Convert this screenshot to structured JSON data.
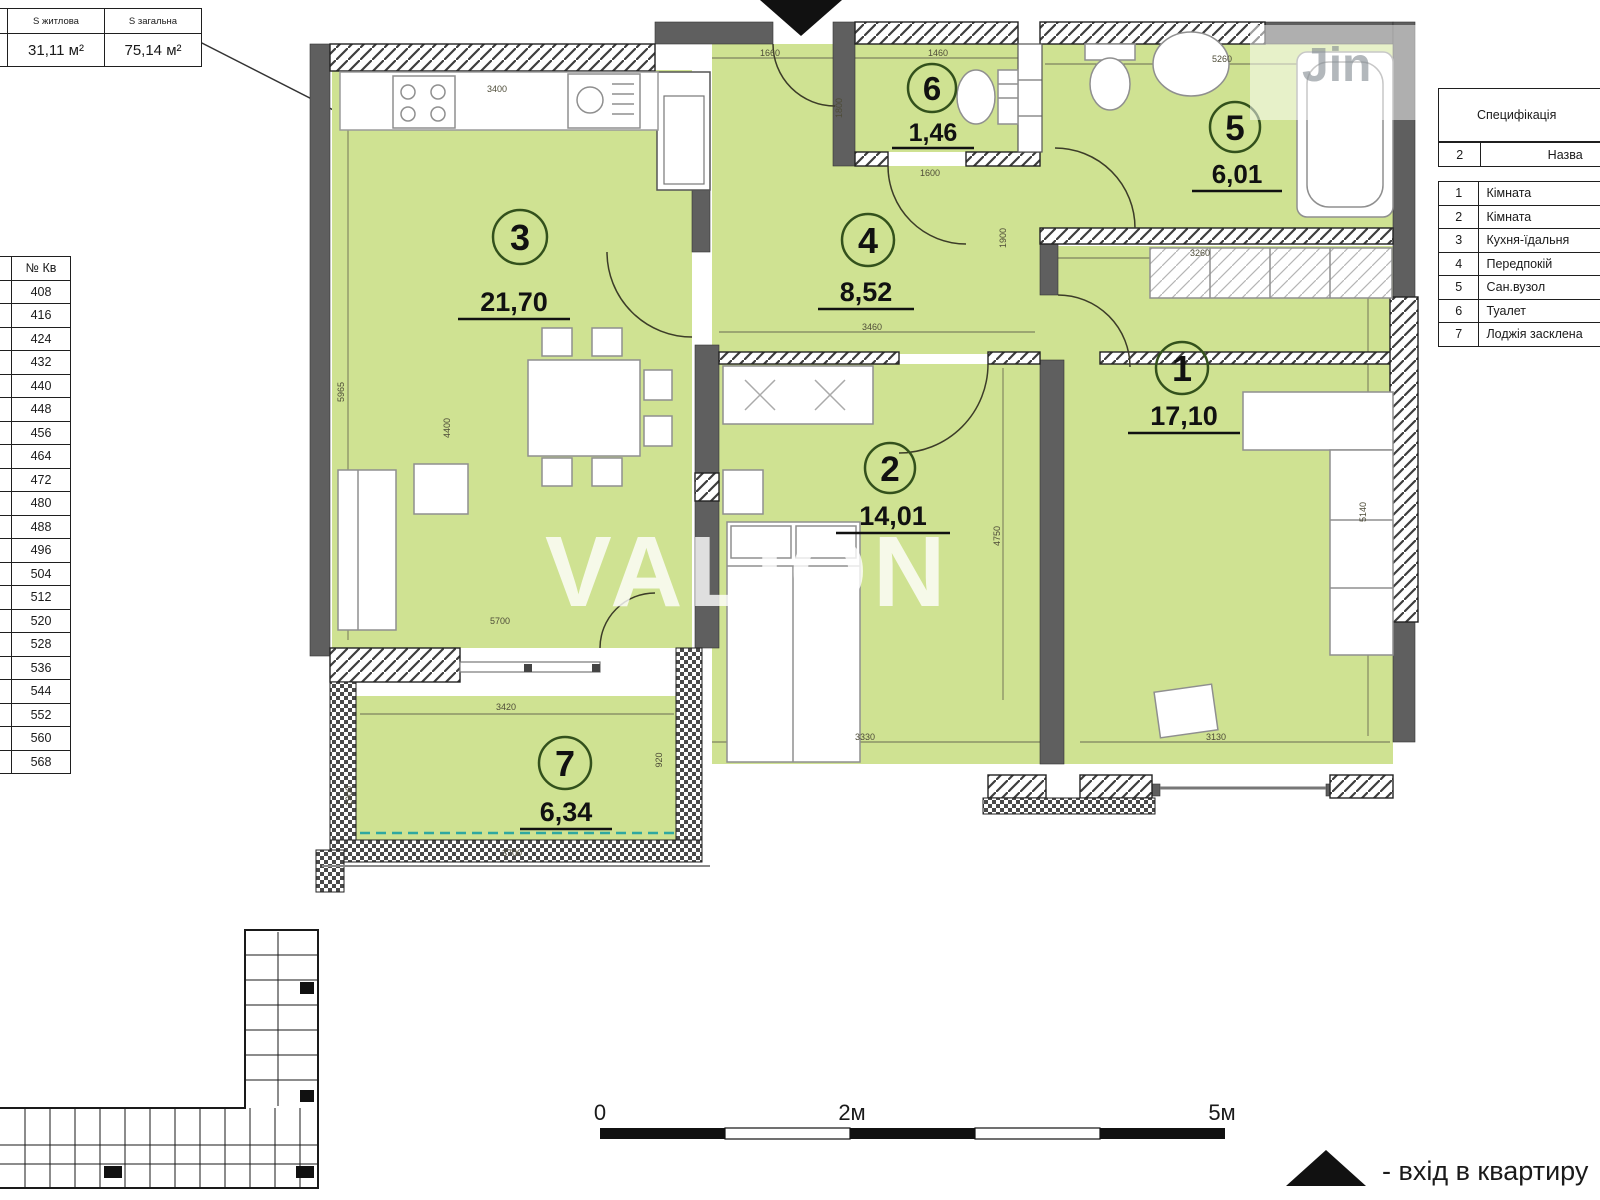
{
  "summary_table": {
    "col_rooms_header": "кімнат",
    "col_rooms_value": "2",
    "col_living_header": "S житлова",
    "col_living_value": "31,11 м²",
    "col_total_header": "S загальна",
    "col_total_value": "75,14 м²"
  },
  "apartments_table": {
    "number_header": "№ Кв",
    "rows": [
      {
        "floor": "2",
        "apt": "408"
      },
      {
        "floor": "3",
        "apt": "416"
      },
      {
        "floor": "4",
        "apt": "424"
      },
      {
        "floor": "5",
        "apt": "432"
      },
      {
        "floor": "6",
        "apt": "440"
      },
      {
        "floor": "7",
        "apt": "448"
      },
      {
        "floor": "8",
        "apt": "456"
      },
      {
        "floor": "9",
        "apt": "464"
      },
      {
        "floor": "10",
        "apt": "472"
      },
      {
        "floor": "11",
        "apt": "480"
      },
      {
        "floor": "12",
        "apt": "488"
      },
      {
        "floor": "13",
        "apt": "496"
      },
      {
        "floor": "14",
        "apt": "504"
      },
      {
        "floor": "15",
        "apt": "512"
      },
      {
        "floor": "16",
        "apt": "520"
      },
      {
        "floor": "17",
        "apt": "528"
      },
      {
        "floor": "18",
        "apt": "536"
      },
      {
        "floor": "19",
        "apt": "544"
      },
      {
        "floor": "20",
        "apt": "552"
      },
      {
        "floor": "21",
        "apt": "560"
      },
      {
        "floor": "22",
        "apt": "568"
      }
    ]
  },
  "spec_table": {
    "title": "Специфікація",
    "header_num": "2",
    "header_name": "Назва",
    "rows": [
      {
        "num": "1",
        "name": "Кімната"
      },
      {
        "num": "2",
        "name": "Кімната"
      },
      {
        "num": "3",
        "name": "Кухня-їдальня"
      },
      {
        "num": "4",
        "name": "Передпокій"
      },
      {
        "num": "5",
        "name": "Сан.вузол"
      },
      {
        "num": "6",
        "name": "Туалет"
      },
      {
        "num": "7",
        "name": "Лоджія засклена"
      }
    ]
  },
  "rooms": {
    "r1": {
      "number": "1",
      "area": "17,10"
    },
    "r2": {
      "number": "2",
      "area": "14,01"
    },
    "r3": {
      "number": "3",
      "area": "21,70"
    },
    "r4": {
      "number": "4",
      "area": "8,52"
    },
    "r5": {
      "number": "5",
      "area": "6,01"
    },
    "r6": {
      "number": "6",
      "area": "1,46"
    },
    "r7": {
      "number": "7",
      "area": "6,34"
    }
  },
  "dims": [
    "3400",
    "1660",
    "1460",
    "5260",
    "1800",
    "1600",
    "3460",
    "3260",
    "1900",
    "5965",
    "4400",
    "5700",
    "4750",
    "5140",
    "3330",
    "3130",
    "3420",
    "3700",
    "1900",
    "920"
  ],
  "watermark": {
    "primary": "VALION",
    "secondary": "Jin"
  },
  "scale": {
    "zero": "0",
    "two": "2м",
    "five": "5м"
  },
  "entrance_note": "- вхід в квартиру",
  "colors": {
    "room_fill": "#cfe292",
    "wall": "#5f5f5f",
    "teal_dashed": "#2fa8a0",
    "accent_circle": "#33511c"
  }
}
